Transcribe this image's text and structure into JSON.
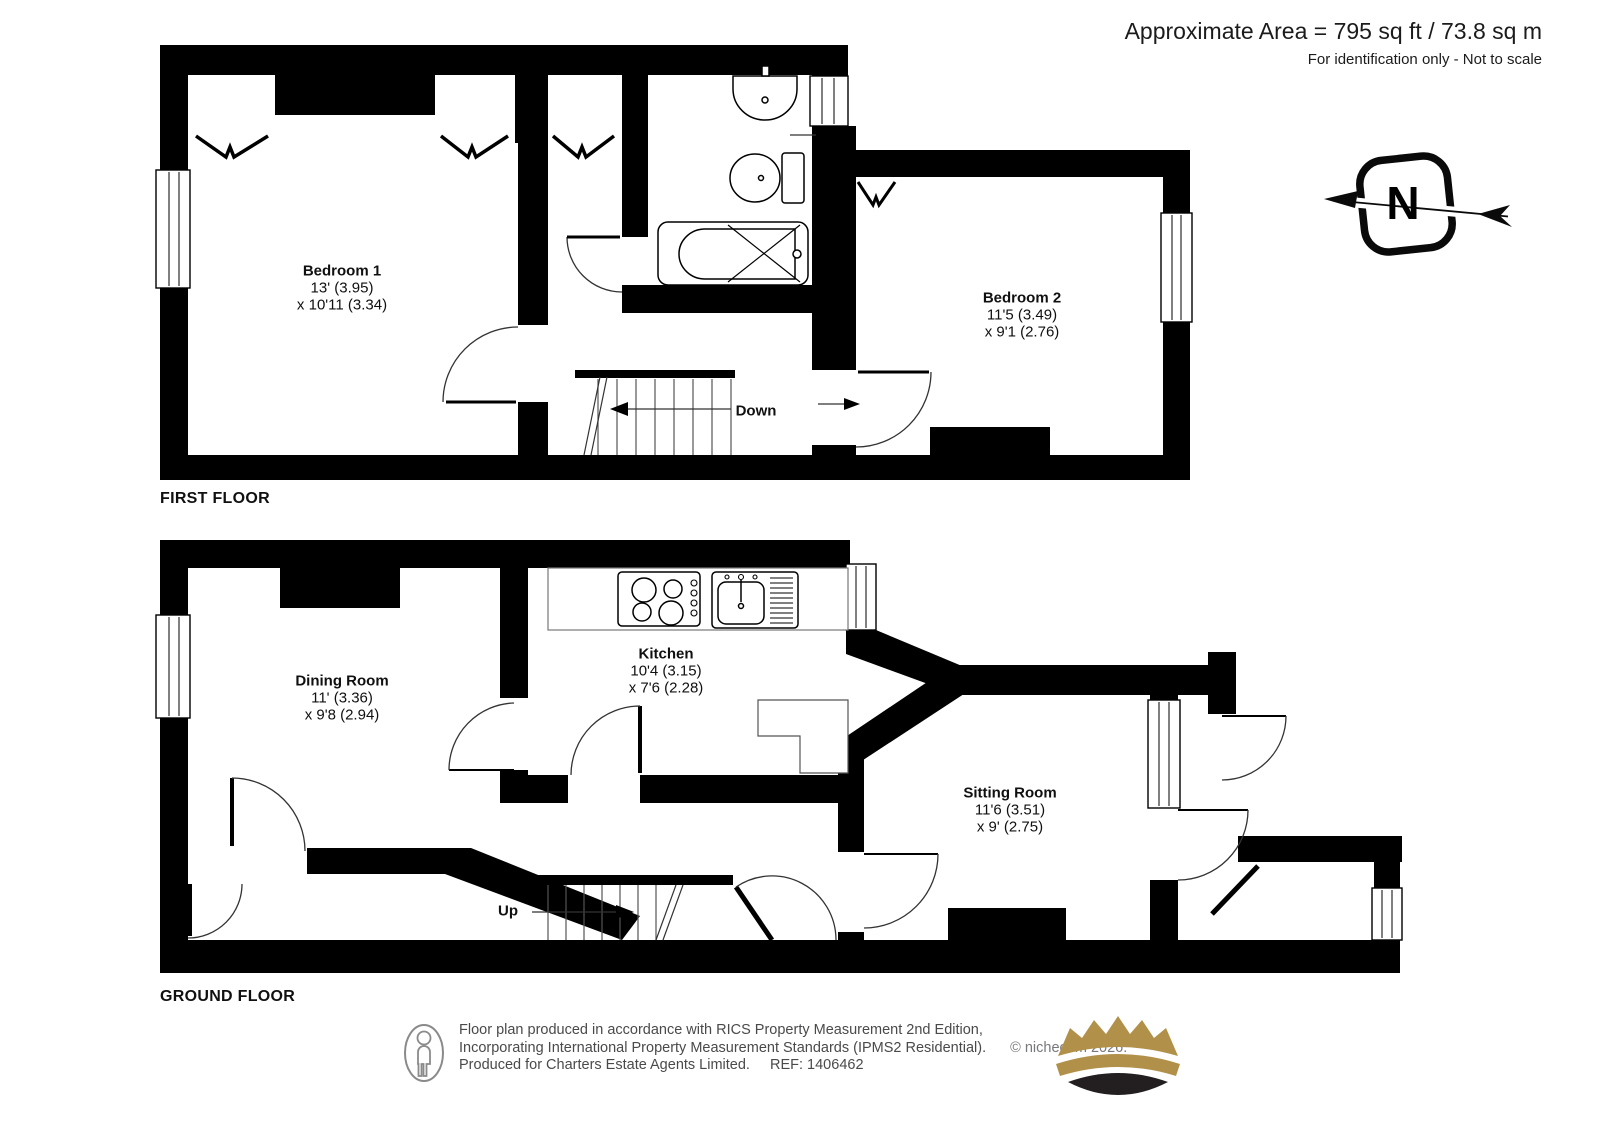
{
  "header": {
    "area": "Approximate Area = 795 sq ft / 73.8 sq m",
    "note": "For identification only - Not to scale"
  },
  "compass": {
    "label": "N"
  },
  "first_floor": {
    "title": "FIRST FLOOR",
    "stairs_label": "Down",
    "bedroom1": {
      "name": "Bedroom 1",
      "dim_line1": "13' (3.95)",
      "dim_line2": "x 10'11 (3.34)"
    },
    "bedroom2": {
      "name": "Bedroom 2",
      "dim_line1": "11'5 (3.49)",
      "dim_line2": "x 9'1 (2.76)"
    }
  },
  "ground_floor": {
    "title": "GROUND FLOOR",
    "stairs_label": "Up",
    "dining": {
      "name": "Dining Room",
      "dim_line1": "11' (3.36)",
      "dim_line2": "x 9'8 (2.94)"
    },
    "kitchen": {
      "name": "Kitchen",
      "dim_line1": "10'4 (3.15)",
      "dim_line2": "x 7'6 (2.28)"
    },
    "sitting": {
      "name": "Sitting Room",
      "dim_line1": "11'6 (3.51)",
      "dim_line2": "x 9' (2.75)"
    }
  },
  "footer": {
    "line1": "Floor plan produced in accordance with RICS Property Measurement 2nd Edition,",
    "line2": "Incorporating International Property Measurement Standards (IPMS2 Residential).",
    "copyright": "© nichecom 2026.",
    "line3": "Produced for Charters Estate Agents Limited.",
    "ref": "REF: 1406462"
  },
  "colors": {
    "wall": "#000000",
    "crown_gold": "#b1914a",
    "crown_base": "#231f20",
    "muted_text": "#77787b"
  }
}
